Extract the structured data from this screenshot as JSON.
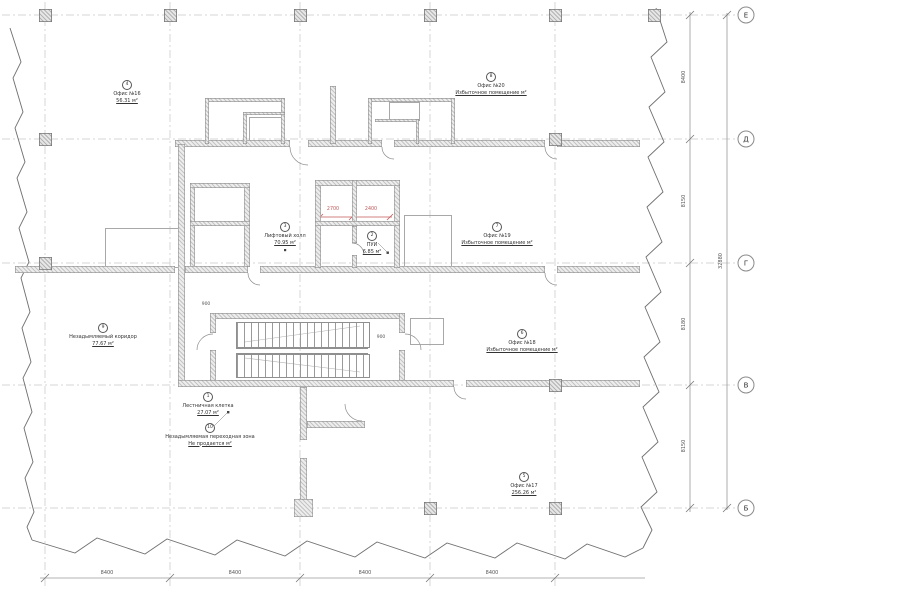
{
  "rooms": [
    {
      "circle": "4",
      "name": "Офис №16",
      "area": "56.31 м²"
    },
    {
      "circle": "8",
      "name": "Офис №20",
      "area": "Избыточное помещение м²"
    },
    {
      "circle": "7",
      "name": "Офис №19",
      "area": "Избыточное помещение м²"
    },
    {
      "circle": "6",
      "name": "Офис №18",
      "area": "Избыточное помещение м²"
    },
    {
      "circle": "5",
      "name": "Офис №17",
      "area": "256.26 м²"
    },
    {
      "circle": "3",
      "name": "Лифтовый холл",
      "area": "70.95 м²"
    },
    {
      "circle": "2",
      "name": "ПУИ",
      "area": "6.85 м²"
    },
    {
      "circle": "9",
      "name": "Незадымляемый коридор",
      "area": "77.67 м²"
    },
    {
      "circle": "1",
      "name": "Лестничная клетка",
      "area": "27.07 м²"
    },
    {
      "circle": "10",
      "name": "Незадымляемая переходная зона",
      "area": "Не продается м²"
    }
  ],
  "grid": {
    "letters": [
      "Е",
      "Д",
      "Г",
      "В",
      "Б"
    ]
  },
  "dims": {
    "bottom": [
      "8400",
      "8400",
      "8400",
      "8400"
    ],
    "right": [
      "8400",
      "8150",
      "8180",
      "8150"
    ],
    "total": "32880",
    "red": [
      "2700",
      "2400"
    ],
    "small": [
      "900",
      "900"
    ]
  },
  "colors": {
    "red_dim": "#c05858",
    "grid_line": "#c6c6ca",
    "wall_edge": "#8f8f8f"
  }
}
